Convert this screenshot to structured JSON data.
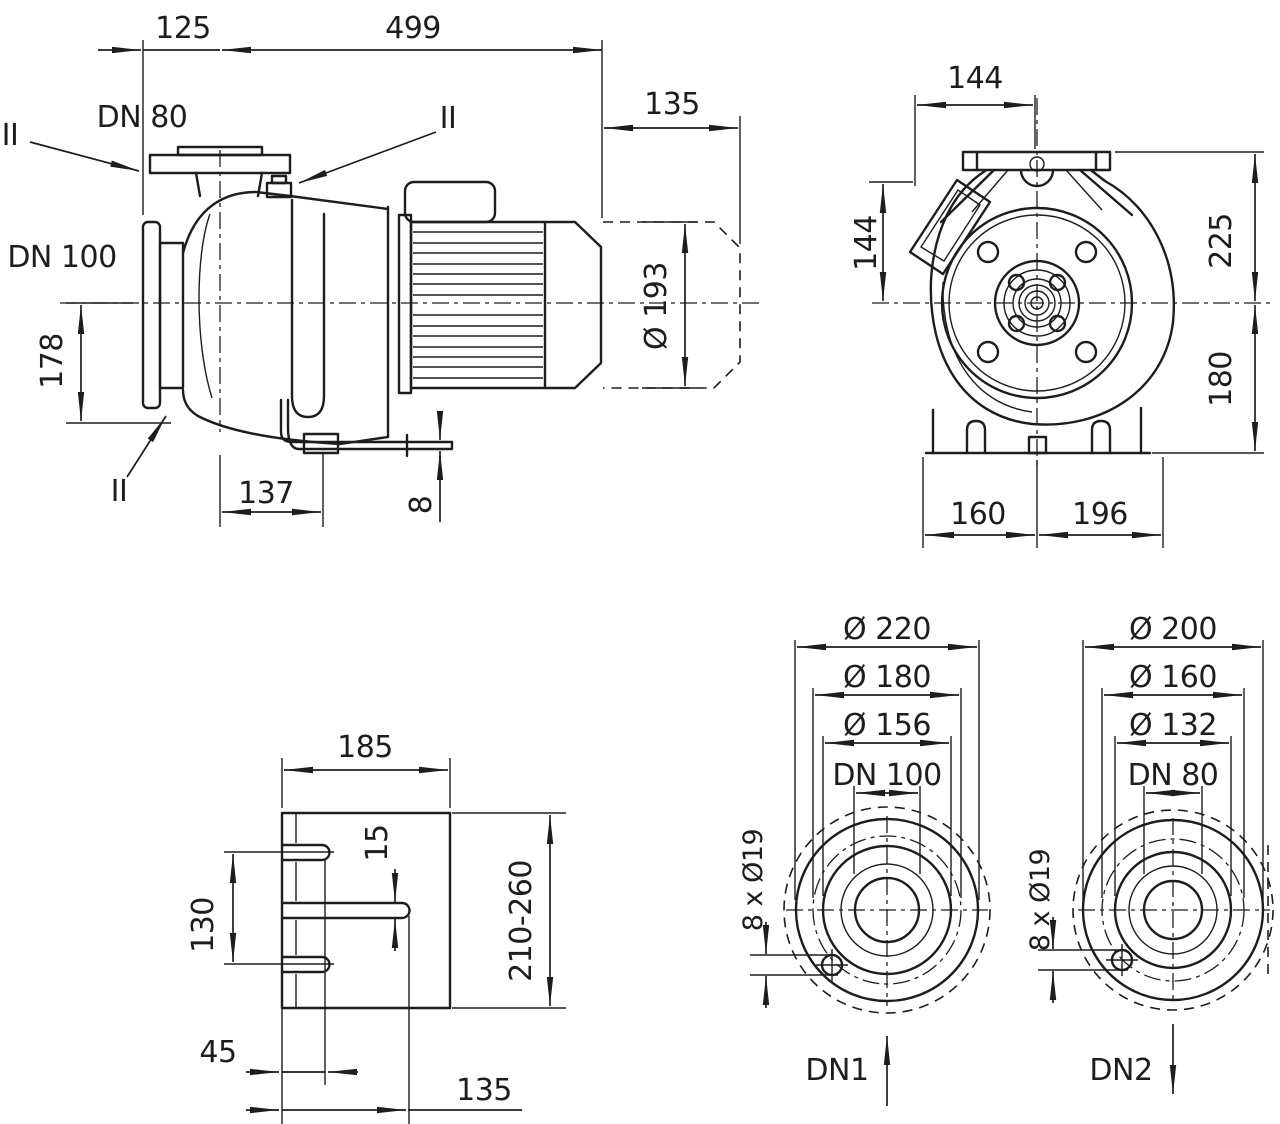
{
  "meta": {
    "background_color": "#ffffff",
    "line_color": "#1d1d1b",
    "drawing_type": "pump dimensional drawing"
  },
  "side_view": {
    "dims": {
      "d125": "125",
      "d499": "499",
      "d135": "135",
      "d178": "178",
      "d137": "137",
      "d8": "8",
      "d193": "Ø 193"
    },
    "labels": {
      "dn80": "DN 80",
      "dn100": "DN 100",
      "m1": "II",
      "m2": "II",
      "m3": "II"
    }
  },
  "front_view": {
    "dims": {
      "w144": "144",
      "h144": "144",
      "h225": "225",
      "h180": "180",
      "w160": "160",
      "w196": "196"
    }
  },
  "support_view": {
    "dims": {
      "w185": "185",
      "h130": "130",
      "s15": "15",
      "range": "210-260",
      "w45": "45",
      "w135": "135"
    }
  },
  "flange_dn100": {
    "dims": {
      "od": "Ø 220",
      "bc": "Ø 180",
      "rf": "Ø 156",
      "dn": "DN 100",
      "holes": "8 x Ø19"
    },
    "port": "DN1"
  },
  "flange_dn80": {
    "dims": {
      "od": "Ø 200",
      "bc": "Ø 160",
      "rf": "Ø 132",
      "dn": "DN 80",
      "holes": "8 x Ø19"
    },
    "port": "DN2"
  }
}
